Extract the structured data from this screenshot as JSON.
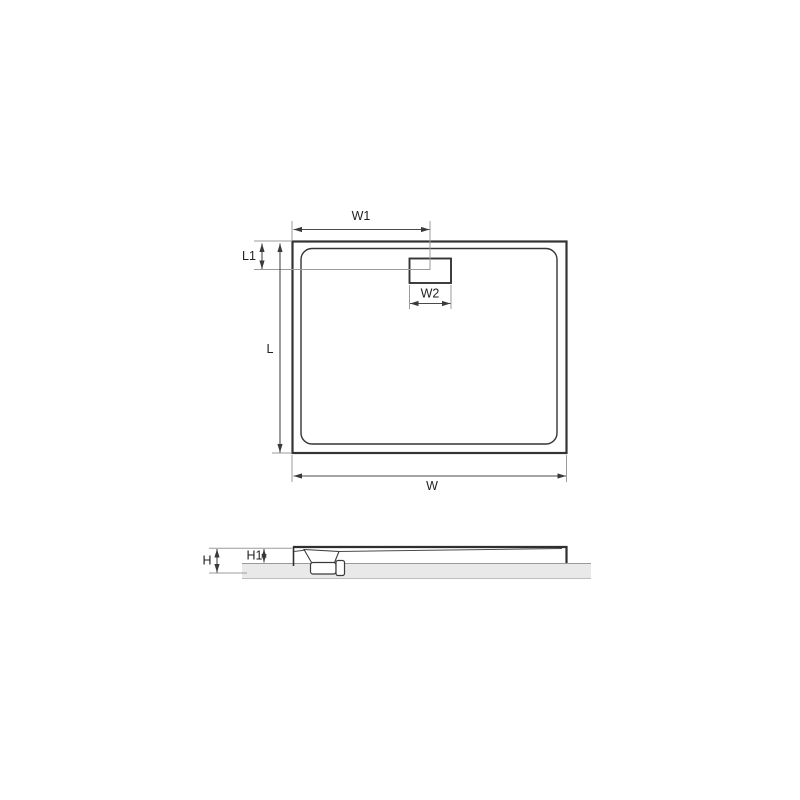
{
  "drawing": {
    "kind": "shower-tray-technical-drawing",
    "colors": {
      "background": "#ffffff",
      "outline": "#343434",
      "dimension_line": "#4a4a4a",
      "extension_line": "#9b9b9b",
      "label_text": "#1f1f1f",
      "floor_fill": "#e9e9e9",
      "floor_edge": "#9a9a9a"
    },
    "top_view": {
      "labels": {
        "w1": "W1",
        "l1": "L1",
        "w2": "W2",
        "l": "L",
        "w": "W"
      }
    },
    "side_view": {
      "labels": {
        "h": "H",
        "h1": "H1"
      }
    }
  }
}
